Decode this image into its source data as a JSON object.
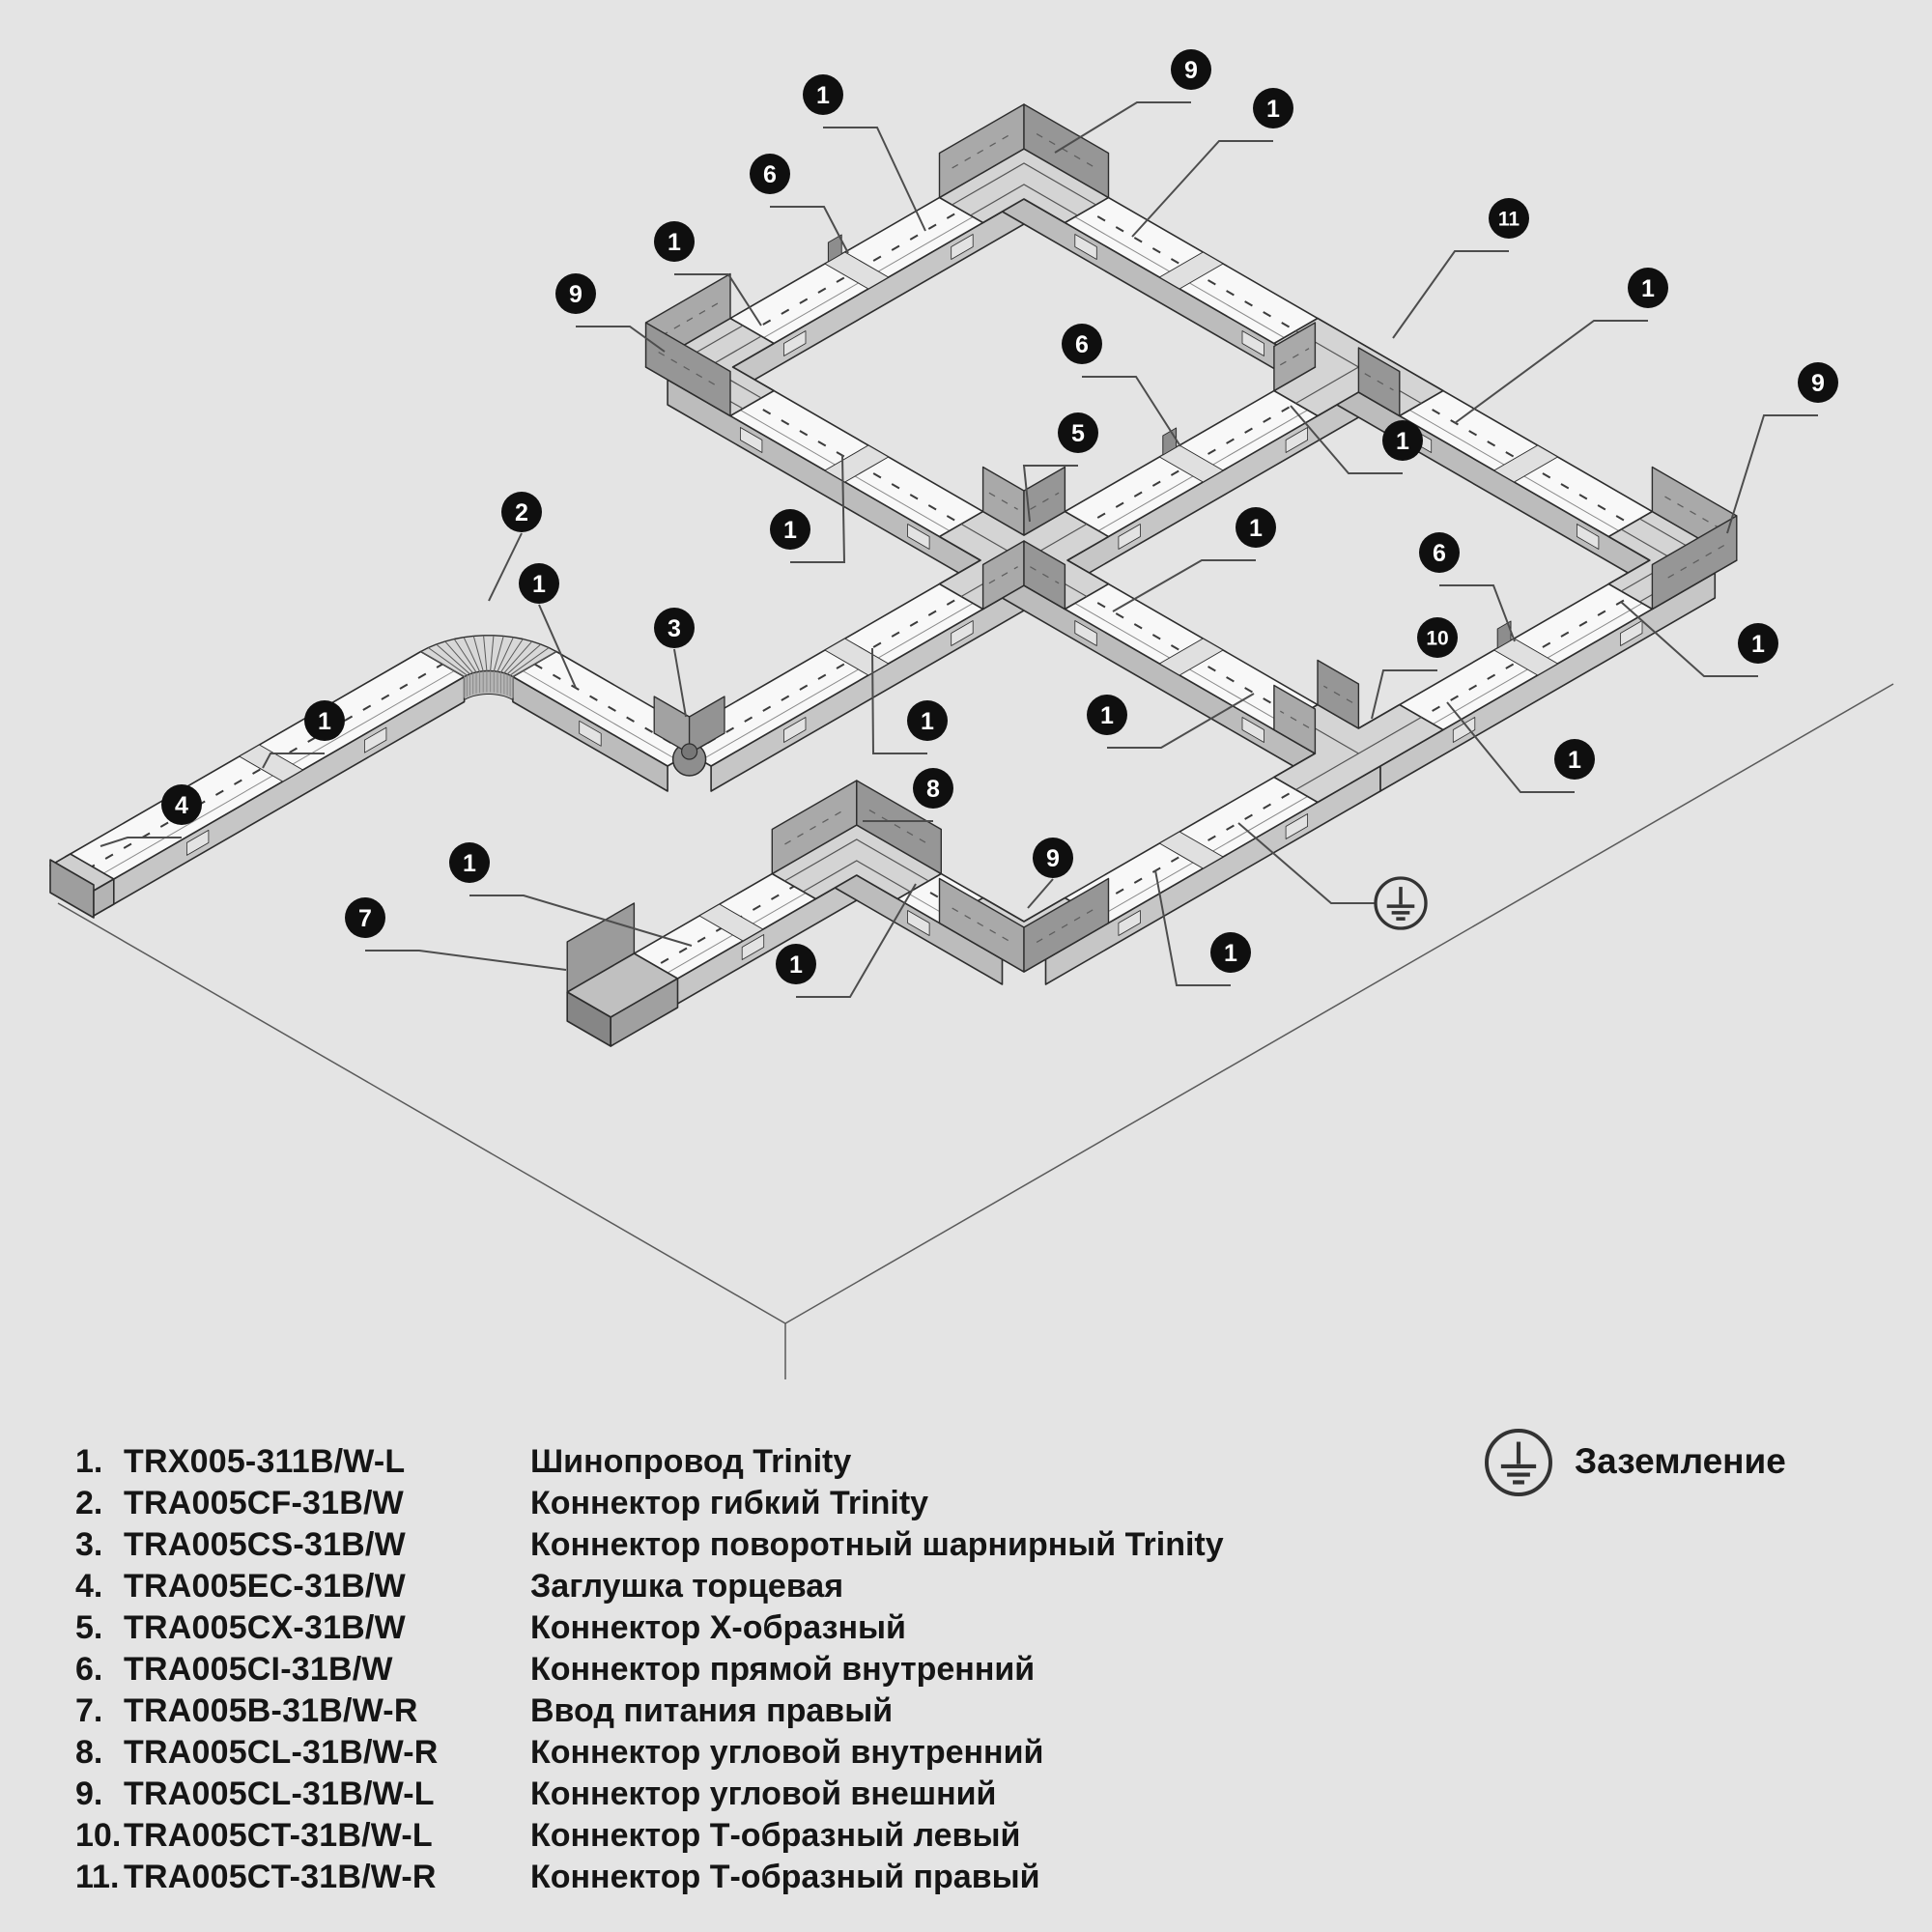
{
  "ground_legend": {
    "label": "Заземление"
  },
  "legend": {
    "items": [
      {
        "num": "1.",
        "code": "TRX005-311B/W-L",
        "desc": "Шинопровод Trinity"
      },
      {
        "num": "2.",
        "code": "TRA005CF-31B/W",
        "desc": "Коннектор гибкий Trinity"
      },
      {
        "num": "3.",
        "code": "TRA005CS-31B/W",
        "desc": "Коннектор поворотный шарнирный Trinity"
      },
      {
        "num": "4.",
        "code": "TRA005EC-31B/W",
        "desc": "Заглушка торцевая"
      },
      {
        "num": "5.",
        "code": "TRA005CX-31B/W",
        "desc": "Коннектор Х-образный"
      },
      {
        "num": "6.",
        "code": "TRA005CI-31B/W",
        "desc": "Коннектор прямой внутренний"
      },
      {
        "num": "7.",
        "code": "TRA005B-31B/W-R",
        "desc": "Ввод питания правый"
      },
      {
        "num": "8.",
        "code": "TRA005CL-31B/W-R",
        "desc": "Коннектор угловой внутренний"
      },
      {
        "num": "9.",
        "code": "TRA005CL-31B/W-L",
        "desc": "Коннектор угловой внешний"
      },
      {
        "num": "10.",
        "code": "TRA005CT-31B/W-L",
        "desc": "Коннектор Т-образный левый"
      },
      {
        "num": "11.",
        "code": "TRA005CT-31B/W-R",
        "desc": "Коннектор Т-образный правый"
      }
    ]
  },
  "colors": {
    "background": "#e4e4e4",
    "line": "#2d2d2d",
    "track_top": "#f8f8f8",
    "wall_e": "#c6c6c6",
    "wall_s": "#bcbcbc",
    "connector_top": "#d4d4d4",
    "fin_a": "#a9a9a9",
    "fin_b": "#969696",
    "tab": "#8d8d8d",
    "joint": "#e0e0e0",
    "window": "#e3e3e3",
    "dash": "#3c3c3c",
    "leader": "#4d4d4d",
    "callout_bg": "#0f0f0f",
    "callout_text": "#ffffff",
    "floor": "#5a5a5a"
  },
  "diagram": {
    "iso": {
      "unit": 200,
      "origin": [
        1060,
        580
      ],
      "half_width": 26,
      "wall_h": 26,
      "fin_h": 46,
      "arm": 75
    },
    "nodes": {
      "X5": [
        0,
        0
      ],
      "B": [
        0,
        -2
      ],
      "A": [
        2,
        -2
      ],
      "T11": [
        2,
        0
      ],
      "R": [
        2,
        2
      ],
      "T10": [
        0,
        2
      ],
      "C9B": [
        -2,
        2
      ],
      "C8B": [
        -2,
        1
      ],
      "FEED7": [
        -3.5,
        1
      ],
      "HINGE3": [
        -2,
        0
      ],
      "FLEX2": [
        -2,
        -1.2
      ],
      "CAP4": [
        -4.4,
        -1.2
      ]
    },
    "runs": [
      {
        "from": "B",
        "to": "A",
        "dir": "E"
      },
      {
        "from": "A",
        "to": "T11",
        "dir": "S"
      },
      {
        "from": "B",
        "to": "X5",
        "dir": "S"
      },
      {
        "from": "X5",
        "to": "T11",
        "dir": "E"
      },
      {
        "from": "T11",
        "to": "R",
        "dir": "S"
      },
      {
        "from": "HINGE3",
        "to": "X5",
        "dir": "E"
      },
      {
        "from": "X5",
        "to": "T10",
        "dir": "S"
      },
      {
        "from": "T10",
        "to": "R",
        "dir": "E"
      },
      {
        "from": "CAP4",
        "to": "FLEX2",
        "dir": "E",
        "trimEnd": 55
      },
      {
        "from": "FLEX2",
        "to": "HINGE3",
        "dir": "S",
        "trimStart": 55
      },
      {
        "from": "FEED7",
        "to": "C8B",
        "dir": "E"
      },
      {
        "from": "C8B",
        "to": "C9B",
        "dir": "S"
      },
      {
        "from": "C9B",
        "to": "T10",
        "dir": "E"
      }
    ],
    "joints": [
      {
        "at": [
          1,
          -2
        ],
        "dir": "E",
        "tab": true
      },
      {
        "at": [
          1,
          0
        ],
        "dir": "E",
        "tab": true
      },
      {
        "at": [
          1,
          2
        ],
        "dir": "E",
        "tab": true
      },
      {
        "at": [
          2,
          -1
        ],
        "dir": "S",
        "tab": false
      },
      {
        "at": [
          2,
          1
        ],
        "dir": "S",
        "tab": false
      },
      {
        "at": [
          0,
          -1
        ],
        "dir": "S",
        "tab": false
      },
      {
        "at": [
          0,
          1
        ],
        "dir": "S",
        "tab": false
      },
      {
        "at": [
          -1,
          0
        ],
        "dir": "E",
        "tab": false
      },
      {
        "at": [
          -1,
          2
        ],
        "dir": "E",
        "tab": false
      },
      {
        "at": [
          -3.3,
          -1.2
        ],
        "dir": "E",
        "tab": false
      },
      {
        "at": [
          -2.75,
          1
        ],
        "dir": "E",
        "tab": false
      }
    ],
    "connectors": [
      {
        "type": "corner",
        "node": "A",
        "orient": "N",
        "arms": [
          "-E",
          "+S"
        ],
        "part": "9"
      },
      {
        "type": "corner",
        "node": "B",
        "orient": "W",
        "arms": [
          "+E",
          "+S"
        ],
        "part": "9"
      },
      {
        "type": "corner",
        "node": "R",
        "orient": "E",
        "arms": [
          "-S",
          "-E"
        ],
        "part": "9"
      },
      {
        "type": "corner",
        "node": "C9B",
        "orient": "S",
        "arms": [
          "-S",
          "+E"
        ],
        "part": "9"
      },
      {
        "type": "corner",
        "node": "C8B",
        "orient": "N",
        "arms": [
          "-E",
          "+S"
        ],
        "part": "8"
      },
      {
        "type": "tee",
        "node": "T11",
        "through": "S",
        "branch": "-E",
        "part": "11"
      },
      {
        "type": "tee",
        "node": "T10",
        "through": "E",
        "branch": "-S",
        "part": "10"
      },
      {
        "type": "cross",
        "node": "X5",
        "part": "5"
      },
      {
        "type": "hinge",
        "node": "HINGE3",
        "part": "3"
      },
      {
        "type": "flex",
        "node": "FLEX2",
        "radius": 55,
        "part": "2"
      },
      {
        "type": "feed",
        "node": "FEED7",
        "part": "7"
      },
      {
        "type": "cap",
        "node": "CAP4",
        "part": "4"
      }
    ],
    "callouts": [
      {
        "n": "9",
        "c": [
          1233,
          72
        ],
        "t": [
          1092,
          158
        ]
      },
      {
        "n": "1",
        "c": [
          852,
          98
        ],
        "t": [
          958,
          239
        ]
      },
      {
        "n": "1",
        "c": [
          1318,
          112
        ],
        "t": [
          1172,
          245
        ]
      },
      {
        "n": "6",
        "c": [
          797,
          180
        ],
        "t": [
          878,
          262
        ]
      },
      {
        "n": "11",
        "c": [
          1562,
          226
        ],
        "t": [
          1442,
          350
        ]
      },
      {
        "n": "1",
        "c": [
          698,
          250
        ],
        "t": [
          788,
          337
        ]
      },
      {
        "n": "9",
        "c": [
          596,
          304
        ],
        "t": [
          688,
          364
        ]
      },
      {
        "n": "1",
        "c": [
          1706,
          298
        ],
        "t": [
          1506,
          438
        ]
      },
      {
        "n": "9",
        "c": [
          1882,
          396
        ],
        "t": [
          1788,
          552
        ]
      },
      {
        "n": "6",
        "c": [
          1120,
          356
        ],
        "t": [
          1222,
          462
        ]
      },
      {
        "n": "5",
        "c": [
          1116,
          448
        ],
        "t": [
          1066,
          540
        ]
      },
      {
        "n": "1",
        "c": [
          1452,
          456
        ],
        "t": [
          1336,
          420
        ]
      },
      {
        "n": "2",
        "c": [
          540,
          530
        ],
        "t": [
          506,
          622
        ]
      },
      {
        "n": "1",
        "c": [
          818,
          548
        ],
        "t": [
          872,
          471
        ]
      },
      {
        "n": "1",
        "c": [
          1300,
          546
        ],
        "t": [
          1152,
          633
        ]
      },
      {
        "n": "1",
        "c": [
          558,
          604
        ],
        "t": [
          596,
          712
        ]
      },
      {
        "n": "6",
        "c": [
          1490,
          572
        ],
        "t": [
          1568,
          664
        ]
      },
      {
        "n": "3",
        "c": [
          698,
          650
        ],
        "t": [
          710,
          742
        ]
      },
      {
        "n": "10",
        "c": [
          1488,
          660
        ],
        "t": [
          1420,
          744
        ]
      },
      {
        "n": "1",
        "c": [
          1820,
          666
        ],
        "t": [
          1678,
          623
        ]
      },
      {
        "n": "1",
        "c": [
          336,
          746
        ],
        "t": [
          272,
          795
        ]
      },
      {
        "n": "1",
        "c": [
          960,
          746
        ],
        "t": [
          903,
          671
        ]
      },
      {
        "n": "1",
        "c": [
          1146,
          740
        ],
        "t": [
          1298,
          718
        ]
      },
      {
        "n": "1",
        "c": [
          1630,
          786
        ],
        "t": [
          1498,
          727
        ]
      },
      {
        "n": "4",
        "c": [
          188,
          833
        ],
        "t": [
          104,
          876
        ]
      },
      {
        "n": "8",
        "c": [
          966,
          816
        ],
        "t": [
          893,
          850
        ]
      },
      {
        "n": "1",
        "c": [
          486,
          893
        ],
        "t": [
          716,
          979
        ]
      },
      {
        "n": "9",
        "c": [
          1090,
          888
        ],
        "t": [
          1064,
          940
        ]
      },
      {
        "n": "7",
        "c": [
          378,
          950
        ],
        "t": [
          586,
          1004
        ]
      },
      {
        "n": "1",
        "c": [
          824,
          998
        ],
        "t": [
          948,
          915
        ]
      },
      {
        "n": "1",
        "c": [
          1274,
          986
        ],
        "t": [
          1196,
          901
        ]
      }
    ],
    "ground_symbol": {
      "center": [
        1450,
        935
      ],
      "r": 26,
      "leader": [
        [
          1282,
          852
        ],
        [
          1378,
          935
        ],
        [
          1423,
          935
        ]
      ]
    },
    "legend_ground_symbol": {
      "center": [
        1572,
        1514
      ],
      "r": 33
    },
    "floor": {
      "lines": [
        [
          [
            60,
            935
          ],
          [
            813,
            1370
          ]
        ],
        [
          [
            813,
            1370
          ],
          [
            1960,
            708
          ]
        ],
        [
          [
            813,
            1370
          ],
          [
            813,
            1428
          ]
        ]
      ]
    }
  }
}
